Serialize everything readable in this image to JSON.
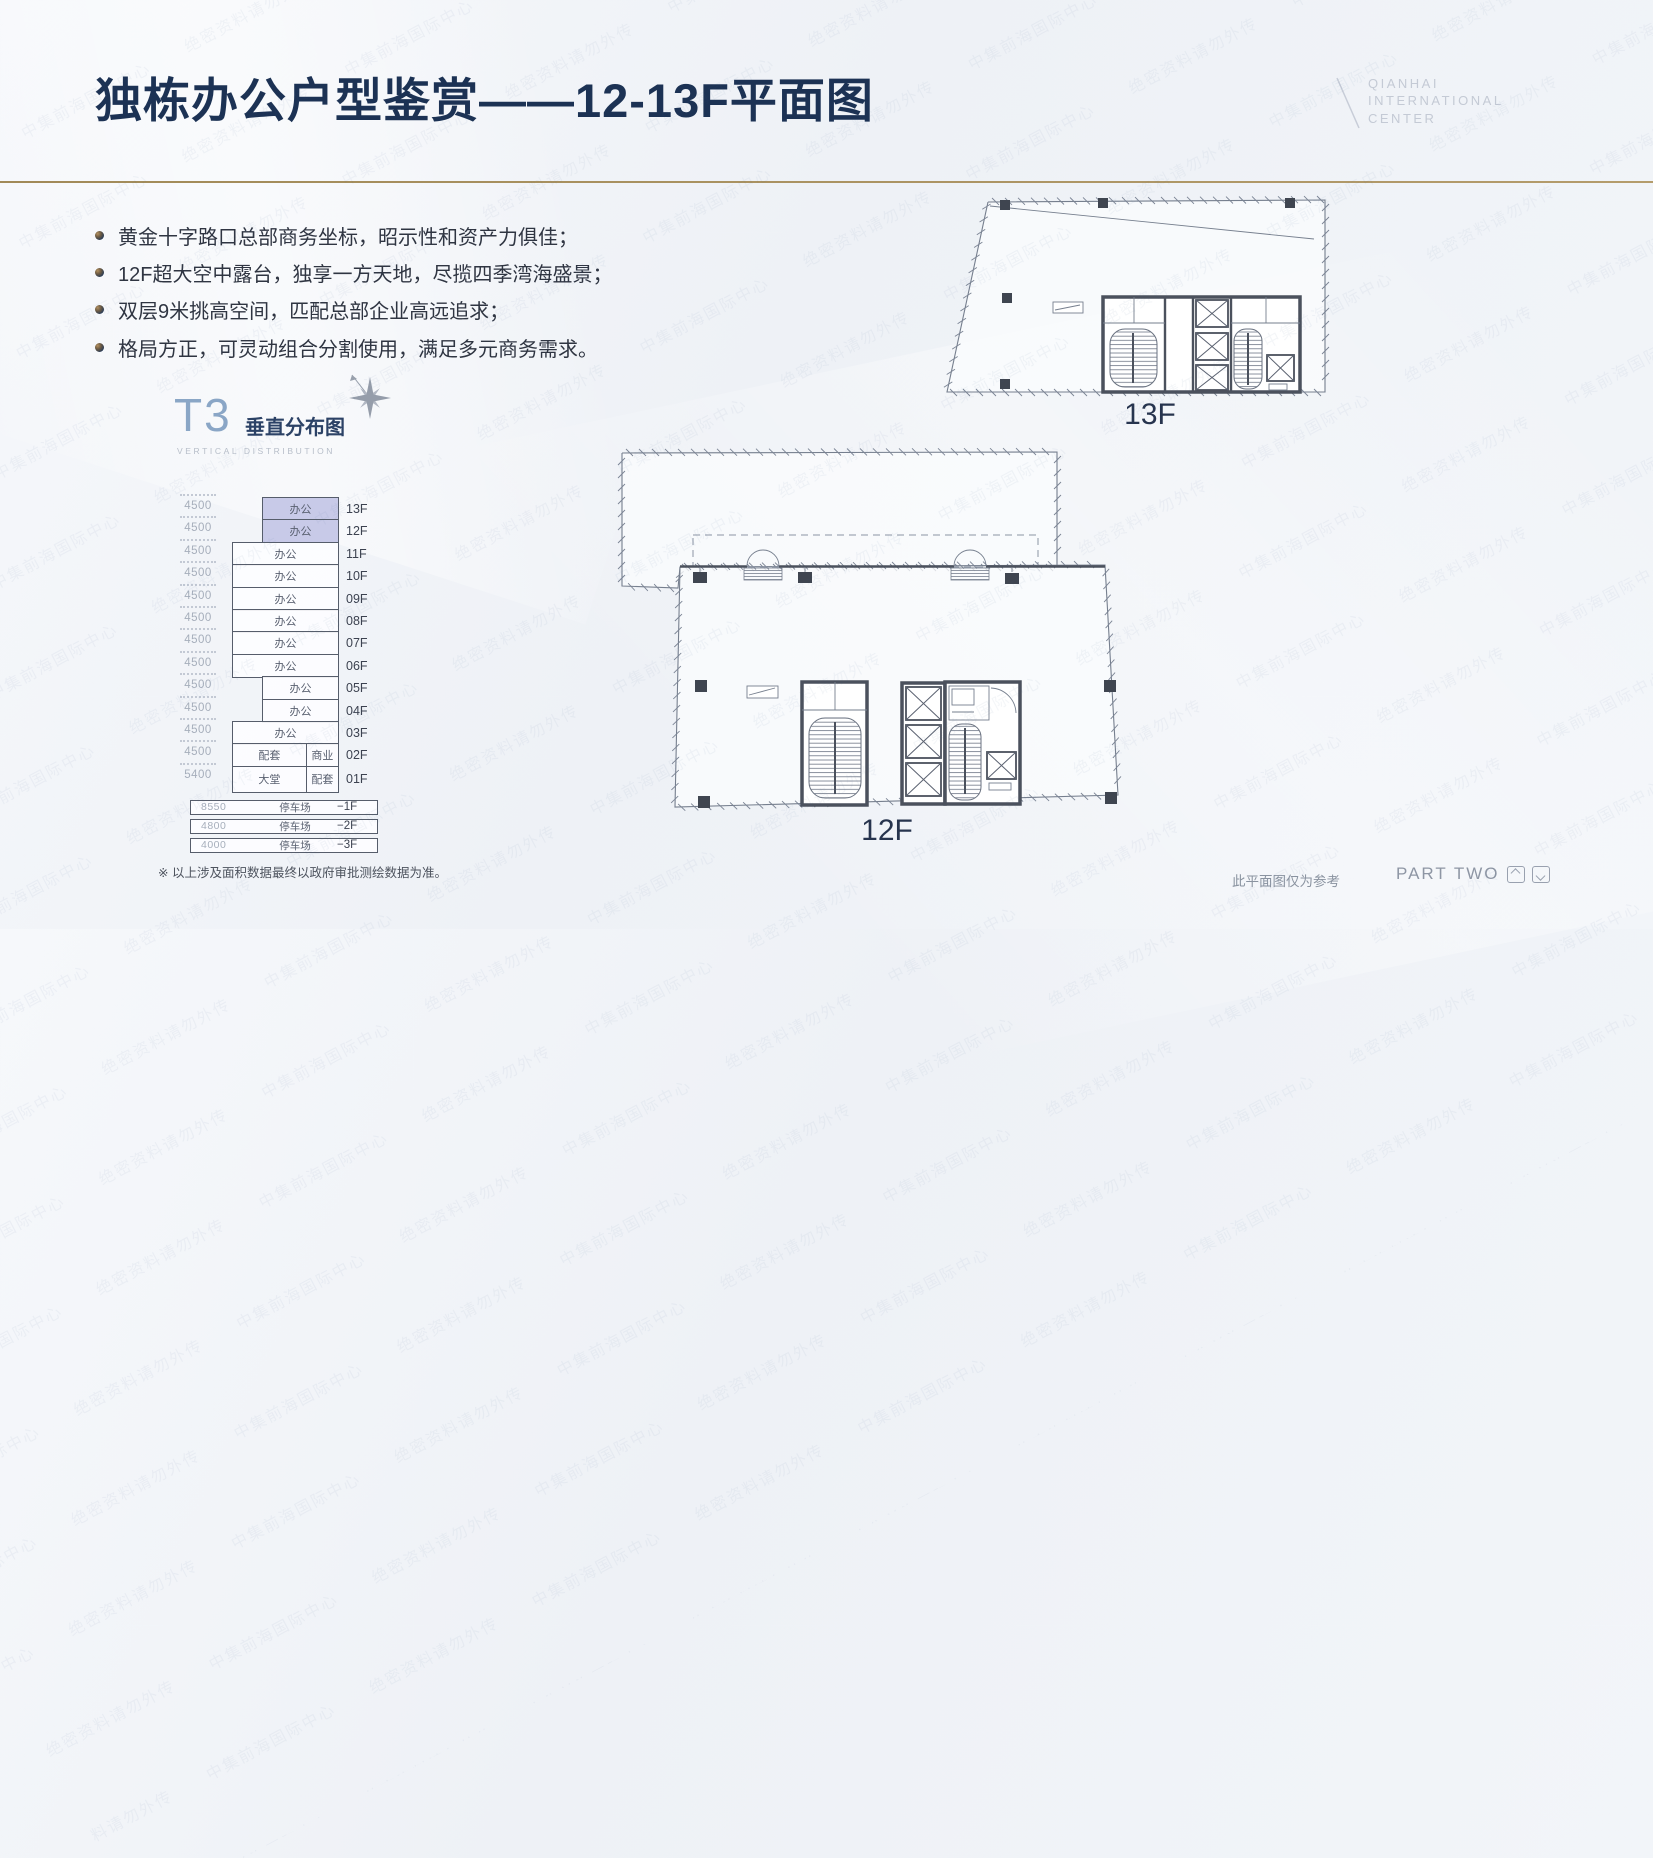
{
  "slide": {
    "title": "独栋办公户型鉴赏——12-13F平面图",
    "brand": {
      "lines": [
        "QIANHAI",
        "INTERNATIONAL",
        "CENTER"
      ]
    },
    "bullets": [
      "黄金十字路口总部商务坐标，昭示性和资产力俱佳；",
      "12F超大空中露台，独享一方天地，尽揽四季湾海盛景；",
      "双层9米挑高空间，匹配总部企业高远追求；",
      "格局方正，可灵动组合分割使用，满足多元商务需求。"
    ],
    "t3": {
      "name": "T3",
      "title_cn": "垂直分布图",
      "title_en": "VERTICAL DISTRIBUTION"
    },
    "distribution": {
      "floors": [
        {
          "floor": "13F",
          "height": "4500",
          "cells": [
            "办公"
          ],
          "indent": true,
          "highlight": true
        },
        {
          "floor": "12F",
          "height": "4500",
          "cells": [
            "办公"
          ],
          "indent": true,
          "highlight": true
        },
        {
          "floor": "11F",
          "height": "4500",
          "cells": [
            "办公"
          ]
        },
        {
          "floor": "10F",
          "height": "4500",
          "cells": [
            "办公"
          ]
        },
        {
          "floor": "09F",
          "height": "4500",
          "cells": [
            "办公"
          ]
        },
        {
          "floor": "08F",
          "height": "4500",
          "cells": [
            "办公"
          ]
        },
        {
          "floor": "07F",
          "height": "4500",
          "cells": [
            "办公"
          ]
        },
        {
          "floor": "06F",
          "height": "4500",
          "cells": [
            "办公"
          ]
        },
        {
          "floor": "05F",
          "height": "4500",
          "cells": [
            "办公"
          ],
          "indent": true
        },
        {
          "floor": "04F",
          "height": "4500",
          "cells": [
            "办公"
          ],
          "indent": true
        },
        {
          "floor": "03F",
          "height": "4500",
          "cells": [
            "办公"
          ]
        },
        {
          "floor": "02F",
          "height": "4500",
          "cells": [
            "配套",
            "商业"
          ]
        },
        {
          "floor": "01F",
          "height": "5400",
          "cells": [
            "大堂",
            "配套"
          ],
          "tall": true
        }
      ],
      "basement": [
        {
          "floor": "−1F",
          "height": "8550",
          "label": "停车场"
        },
        {
          "floor": "−2F",
          "height": "4800",
          "label": "停车场"
        },
        {
          "floor": "−3F",
          "height": "4000",
          "label": "停车场"
        }
      ]
    },
    "plans": {
      "plan13_label": "13F",
      "plan12_label": "12F"
    },
    "footnote": "※ 以上涉及面积数据最终以政府审批测绘数据为准。",
    "disclaimer": "此平面图仅为参考",
    "part_label": "PART TWO",
    "watermark": "中集前海国际中心 绝密资料请勿外传"
  },
  "colors": {
    "title": "#1c3254",
    "accent_gold": "#a68c5d",
    "highlight_fill": "#c8cae8",
    "plan_line": "#767f8e",
    "brand_gray": "#c4cad5"
  }
}
